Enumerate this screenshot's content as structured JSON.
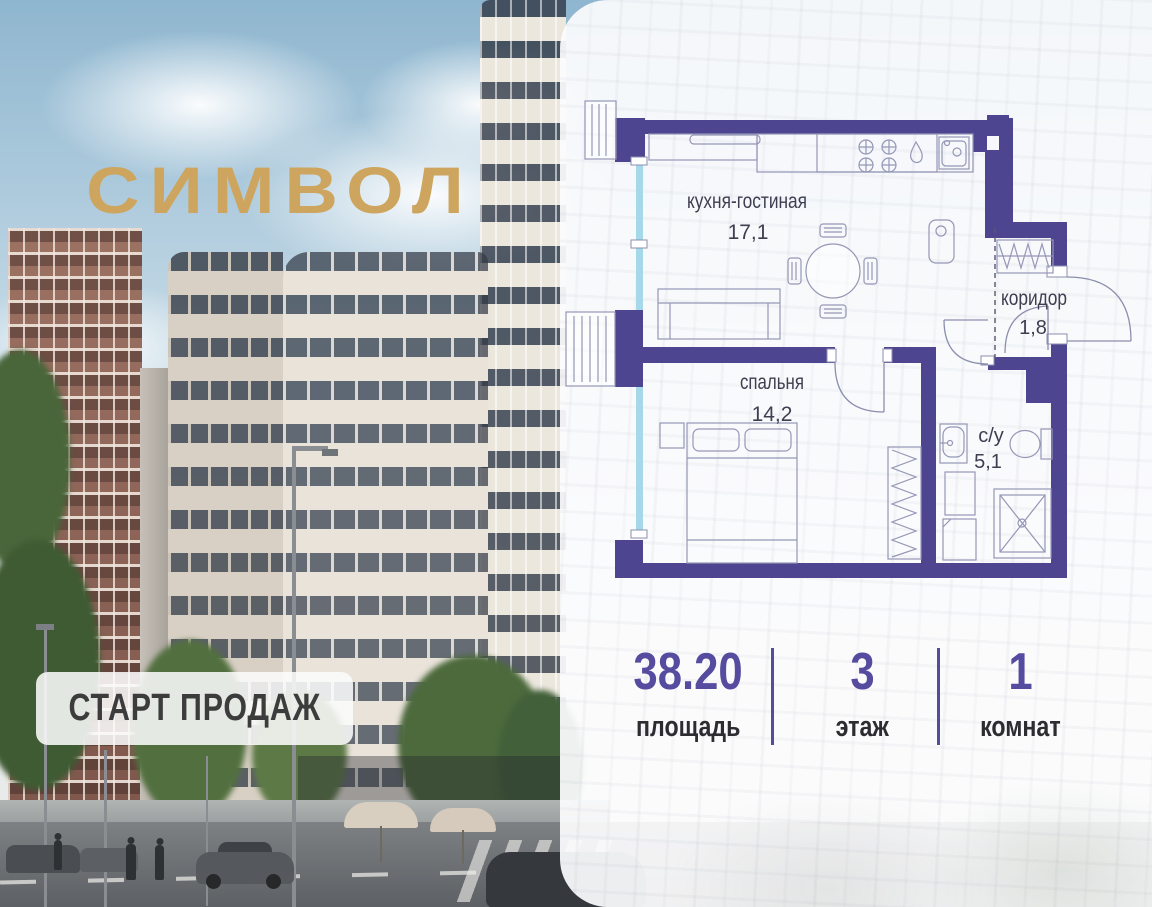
{
  "logo": {
    "text": "СИМВОЛ",
    "color": "#cda55e"
  },
  "badge": {
    "label": "СТАРТ ПРОДАЖ"
  },
  "floor_plan": {
    "rooms": [
      {
        "name": "кухня-гостиная",
        "area": "17,1"
      },
      {
        "name": "спальня",
        "area": "14,2"
      },
      {
        "name": "коридор",
        "area": "1,8"
      },
      {
        "name": "с/у",
        "area": "5,1"
      }
    ],
    "wall_color": "#4e4591",
    "glazing_color": "#a5d9e9"
  },
  "stats": {
    "accent": "#544c9e",
    "items": [
      {
        "value": "38.20",
        "label": "площадь"
      },
      {
        "value": "3",
        "label": "этаж"
      },
      {
        "value": "1",
        "label": "комнат"
      }
    ]
  }
}
